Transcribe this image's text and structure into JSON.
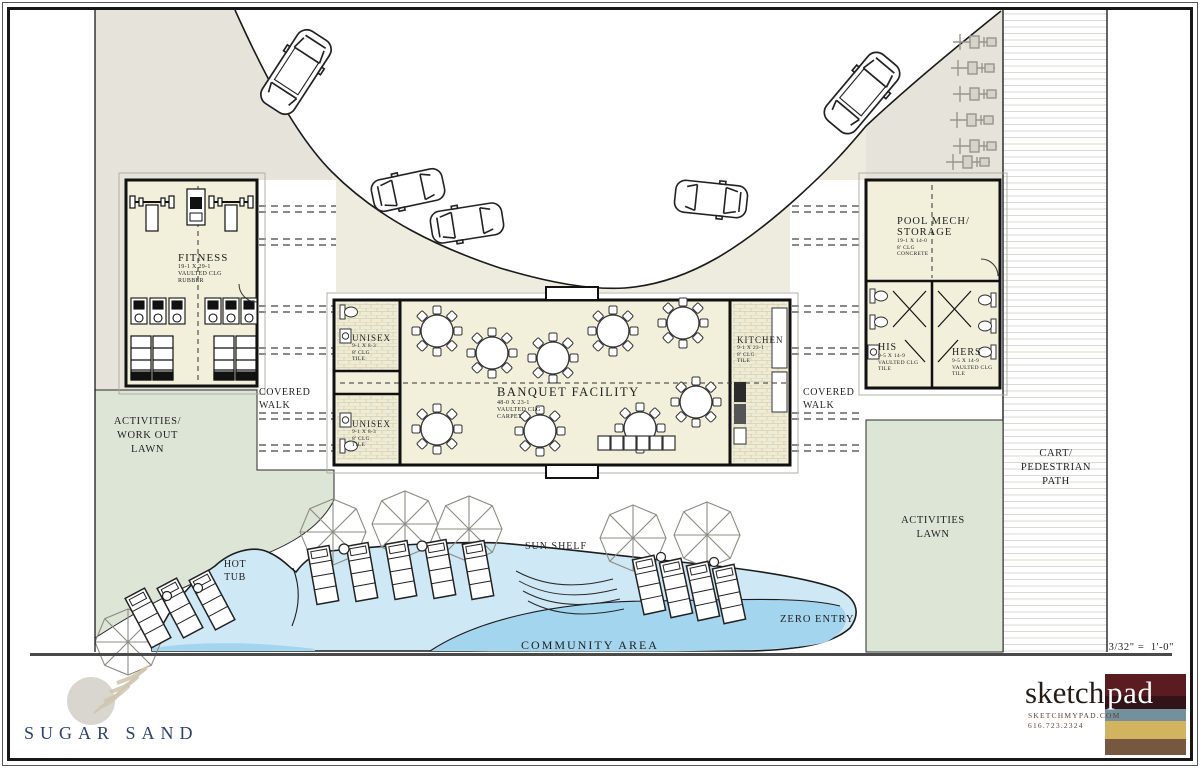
{
  "meta": {
    "community_label": "COMMUNITY AREA",
    "scale": "3/32\" =  1'-0\""
  },
  "rooms": {
    "fitness": {
      "title": "FITNESS",
      "dims": "19-1 X 29-1",
      "ceil": "VAULTED CLG",
      "floor": "RUBBER"
    },
    "unisex_top": {
      "title": "UNISEX",
      "dims": "9-1 X 8-3",
      "ceil": "8' CLG",
      "floor": "TILE"
    },
    "unisex_bottom": {
      "title": "UNISEX",
      "dims": "9-1 X 8-3",
      "ceil": "8' CLG",
      "floor": "TILE"
    },
    "banquet": {
      "title": "BANQUET FACILITY",
      "dims": "48-0 X 23-1",
      "ceil": "VAULTED CLG",
      "floor": "CARPET"
    },
    "kitchen": {
      "title": "KITCHEN",
      "dims": "9-1 X 23-1",
      "ceil": "8' CLG",
      "floor": "TILE"
    },
    "pool_mech": {
      "title": "POOL MECH/",
      "title2": "STORAGE",
      "dims": "19-1 X 14-0",
      "ceil": "8' CLG",
      "floor": "CONCRETE"
    },
    "his": {
      "title": "HIS",
      "dims": "9-5 X 14-9",
      "ceil": "VAULTED CLG",
      "floor": "TILE"
    },
    "hers": {
      "title": "HERS",
      "dims": "9-5 X 14-9",
      "ceil": "VAULTED CLG",
      "floor": "TILE"
    }
  },
  "site": {
    "activities_workout_lawn": "ACTIVITIES/\nWORK OUT\nLAWN",
    "covered_walk_left": "COVERED\nWALK",
    "covered_walk_right": "COVERED\nWALK",
    "cart_path": "CART/\nPEDESTRIAN\nPATH",
    "activities_lawn": "ACTIVITIES\nLAWN",
    "hot_tub": "HOT\nTUB",
    "sun_shelf": "SUN SHELF",
    "zero_entry": "ZERO ENTRY"
  },
  "branding": {
    "community_name": "SUGAR SAND",
    "studio_left": "sketch",
    "studio_right": "pad",
    "studio_web": "SKETCHMYPAD.COM",
    "studio_phone": "616.723.2324"
  },
  "palette": {
    "paving": "#e6e4da",
    "walk": "#edecdf",
    "lawn": "#dce5d6",
    "building": "#f2efdb",
    "pool_light": "#cfe8f6",
    "pool_deep": "#a4d5ee",
    "brand_blue": "#2e4170",
    "circle_gray": "#d9d6d0",
    "feather": "#cfc6b0",
    "logo_red": "#5a1c20",
    "logo_maroon": "#321317",
    "logo_slate": "#74909c",
    "logo_gold": "#d2b360",
    "logo_brown": "#76573f"
  }
}
